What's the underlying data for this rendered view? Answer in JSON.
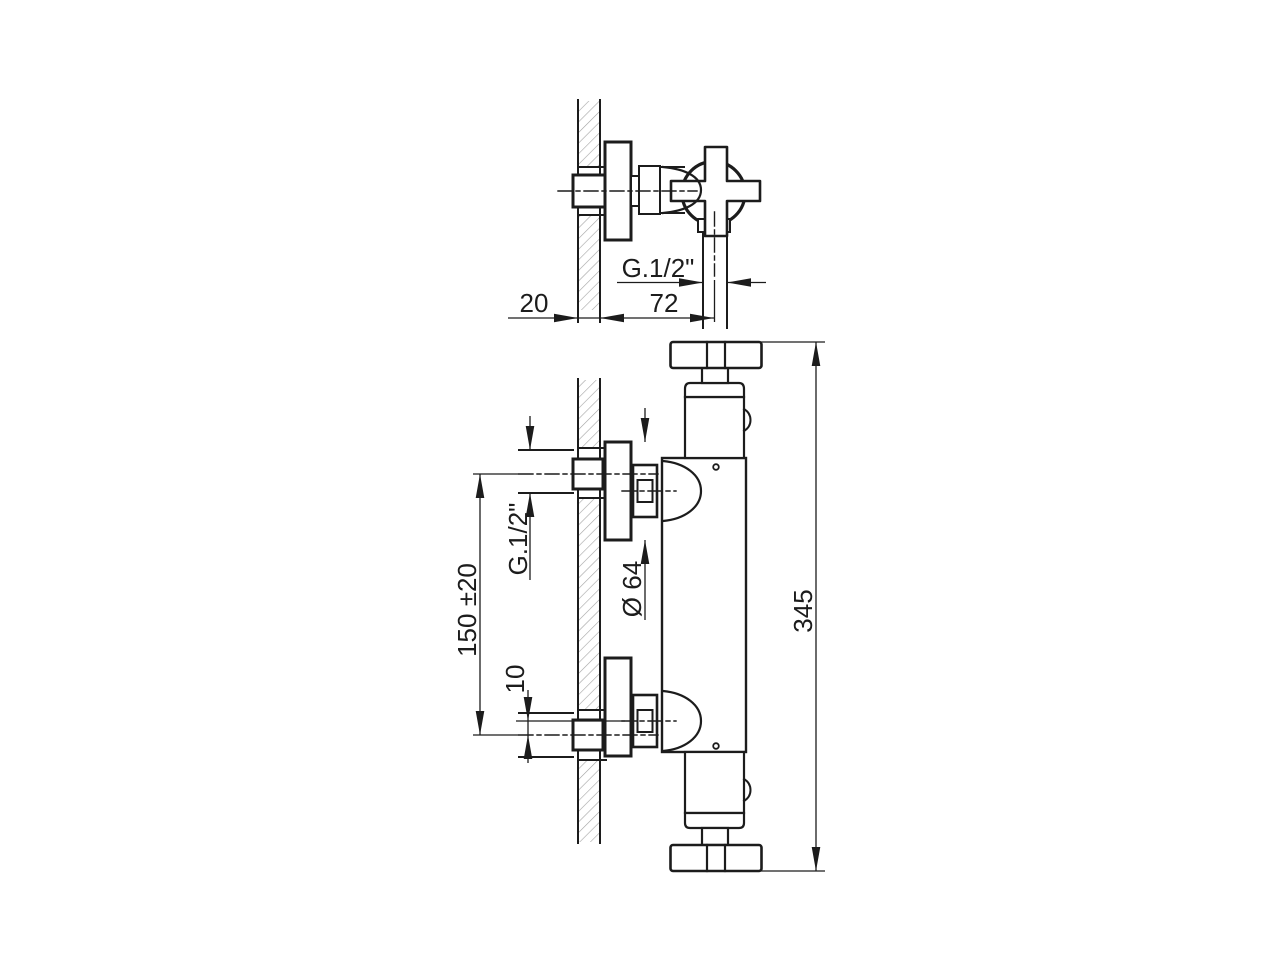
{
  "colors": {
    "ink": "#1c1c1c",
    "hatch": "#a3a3a3",
    "background": "#ffffff"
  },
  "top_view": {
    "thread_label": "G.1/2\"",
    "wall_thickness": "20",
    "wall_to_pipe_axis": "72"
  },
  "front_view": {
    "thread_label": "G.1/2\"",
    "escutcheon_diameter": "Ø 64",
    "inlet_spacing": "150 ±20",
    "eccentric_offset": "10",
    "overall_height": "345"
  }
}
